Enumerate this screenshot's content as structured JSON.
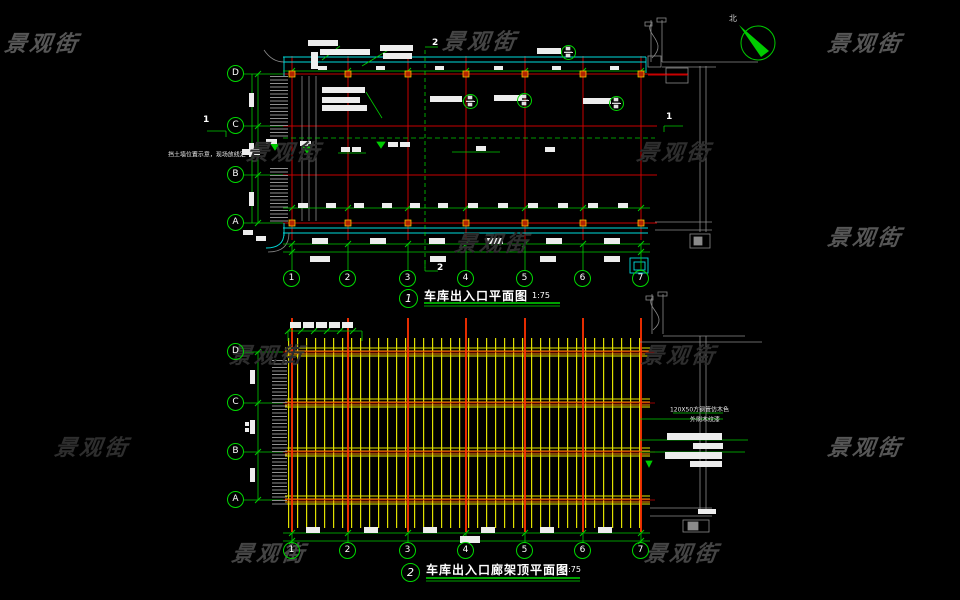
{
  "watermark": {
    "text": "景观街"
  },
  "north_label": "北",
  "drawing1": {
    "number": "1",
    "title": "车库出入口平面图",
    "scale": "1:75",
    "rows": [
      "D",
      "C",
      "B",
      "A"
    ],
    "cols": [
      "1",
      "2",
      "3",
      "4",
      "5",
      "6",
      "7"
    ],
    "section_top": "2",
    "section_bottom": "2",
    "section_left": "1",
    "section_right": "1",
    "note_left": "挡土墙位置示意，现场放线定"
  },
  "drawing2": {
    "number": "2",
    "title": "车库出入口廊架顶平面图",
    "scale": "1:75",
    "rows": [
      "D",
      "C",
      "B",
      "A"
    ],
    "cols": [
      "1",
      "2",
      "3",
      "4",
      "5",
      "6",
      "7"
    ],
    "note1": "120X50方钢管仿木色",
    "note2": "外刷木纹漆"
  },
  "colors": {
    "grid_red": "#c80000",
    "column_red": "#ff3200",
    "wall_cyan": "#00dcdc",
    "dim_green": "#00cc00",
    "slat_yellow": "#e6e600",
    "beam_orange": "#ff9900",
    "wall_gray": "#8a8a8a"
  }
}
